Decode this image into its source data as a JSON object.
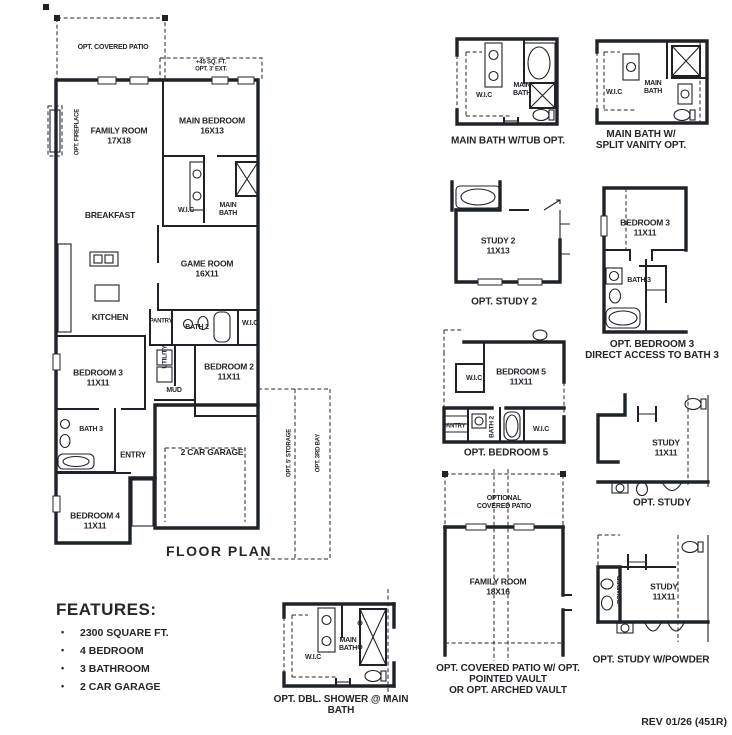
{
  "page": {
    "floor_plan_caption": "FLOOR PLAN",
    "rev_note": "REV 01/26 (451R)"
  },
  "main_plan": {
    "opt_covered_patio": "OPT. COVERED PATIO",
    "ext_sqft": "+45 SQ. FT.",
    "ext_label": "OPT. 3' EXT.",
    "opt_fireplace": "OPT. FIREPLACE",
    "opt_storage": "OPT. 5' STORAGE",
    "opt_third_bay": "OPT. 3RD BAY",
    "family_room": "FAMILY ROOM",
    "family_room_dims": "17X18",
    "main_bedroom": "MAIN BEDROOM",
    "main_bedroom_dims": "16X13",
    "breakfast": "BREAKFAST",
    "wic": "W.I.C",
    "main_bath_l1": "MAIN",
    "main_bath_l2": "BATH",
    "game_room": "GAME ROOM",
    "game_room_dims": "16X11",
    "kitchen": "KITCHEN",
    "pantry": "PANTRY",
    "bath2": "BATH 2",
    "wic2": "W.I.C",
    "utility": "UTILITY",
    "mud": "MUD",
    "bedroom2": "BEDROOM 2",
    "bedroom2_dims": "11X11",
    "bedroom3": "BEDROOM 3",
    "bedroom3_dims": "11X11",
    "bath3": "BATH 3",
    "entry": "ENTRY",
    "garage": "2 CAR GARAGE",
    "bedroom4": "BEDROOM 4",
    "bedroom4_dims": "11X11"
  },
  "features": {
    "title": "FEATURES:",
    "items": [
      "2300 SQUARE FT.",
      "4 BEDROOM",
      "3 BATHROOM",
      "2 CAR GARAGE"
    ]
  },
  "options": {
    "tub": {
      "wic": "W.I.C",
      "main": "MAIN",
      "bath": "BATH",
      "caption": "MAIN BATH W/TUB OPT."
    },
    "split": {
      "wic": "W.I.C",
      "main": "MAIN",
      "bath": "BATH",
      "caption_l1": "MAIN BATH W/",
      "caption_l2": "SPLIT VANITY OPT."
    },
    "study2": {
      "room": "STUDY 2",
      "dims": "11X13",
      "caption": "OPT. STUDY 2"
    },
    "bedroom3": {
      "room": "BEDROOM 3",
      "dims": "11X11",
      "bath": "BATH 3",
      "caption_l1": "OPT. BEDROOM 3",
      "caption_l2": "DIRECT ACCESS TO BATH 3"
    },
    "bedroom5": {
      "room": "BEDROOM 5",
      "dims": "11X11",
      "wic_left": "W.I.C",
      "wic_right": "W.I.C",
      "pantry": "PANTRY",
      "bath2": "BATH 2",
      "caption": "OPT. BEDROOM 5"
    },
    "study": {
      "room": "STUDY",
      "dims": "11X11",
      "caption": "OPT. STUDY"
    },
    "patio": {
      "patio_l1": "OPTIONAL",
      "patio_l2": "COVERED PATIO",
      "room": "FAMILY ROOM",
      "dims": "18X16",
      "caption_l1": "OPT. COVERED PATIO W/ OPT.",
      "caption_l2": "POINTED VAULT",
      "caption_l3": "OR OPT. ARCHED VAULT"
    },
    "powder": {
      "room": "STUDY",
      "dims": "11X11",
      "powder": "POWDER",
      "caption": "OPT. STUDY W/POWDER"
    },
    "dblshower": {
      "wic": "W.I.C",
      "main": "MAIN",
      "bath": "BATH",
      "caption_l1": "OPT. DBL. SHOWER @ MAIN",
      "caption_l2": "BATH"
    }
  }
}
